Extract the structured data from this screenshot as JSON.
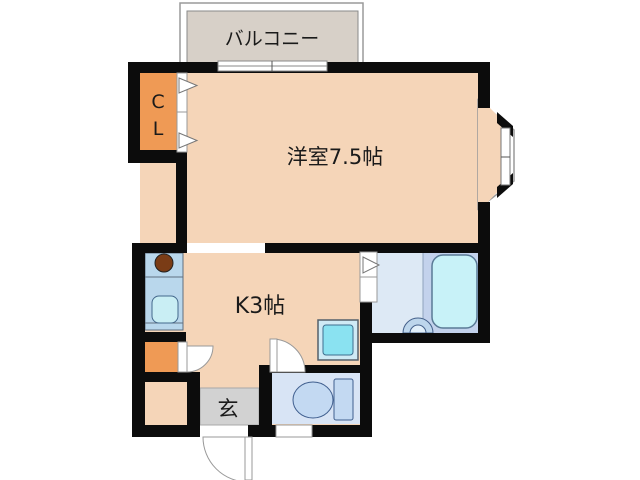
{
  "floorplan": {
    "balcony_label": "バルコニー",
    "closet_label_line1": "C",
    "closet_label_line2": "L",
    "main_room_label": "洋室7.5帖",
    "kitchen_label": "K3帖",
    "entrance_label": "玄",
    "colors": {
      "wall": "#0c0c0c",
      "room_floor": "#f5d5b8",
      "closet_orange": "#ef9a55",
      "balcony_gray": "#d7d0c8",
      "entrance_gray": "#d2d2d2",
      "counter_blue": "#b9d7ec",
      "sink_cyan": "#c9eef4",
      "burner_brown": "#7a3c16",
      "washroom_blue": "#dde9f5",
      "bath_zone_blue": "#c3d2ec",
      "bathtub_cyan": "#c8f2f8",
      "toilet_room_blue": "#d8e4f5",
      "fixture_blue": "#c3d9f2",
      "washer_cyan": "#8ae2f1"
    }
  }
}
